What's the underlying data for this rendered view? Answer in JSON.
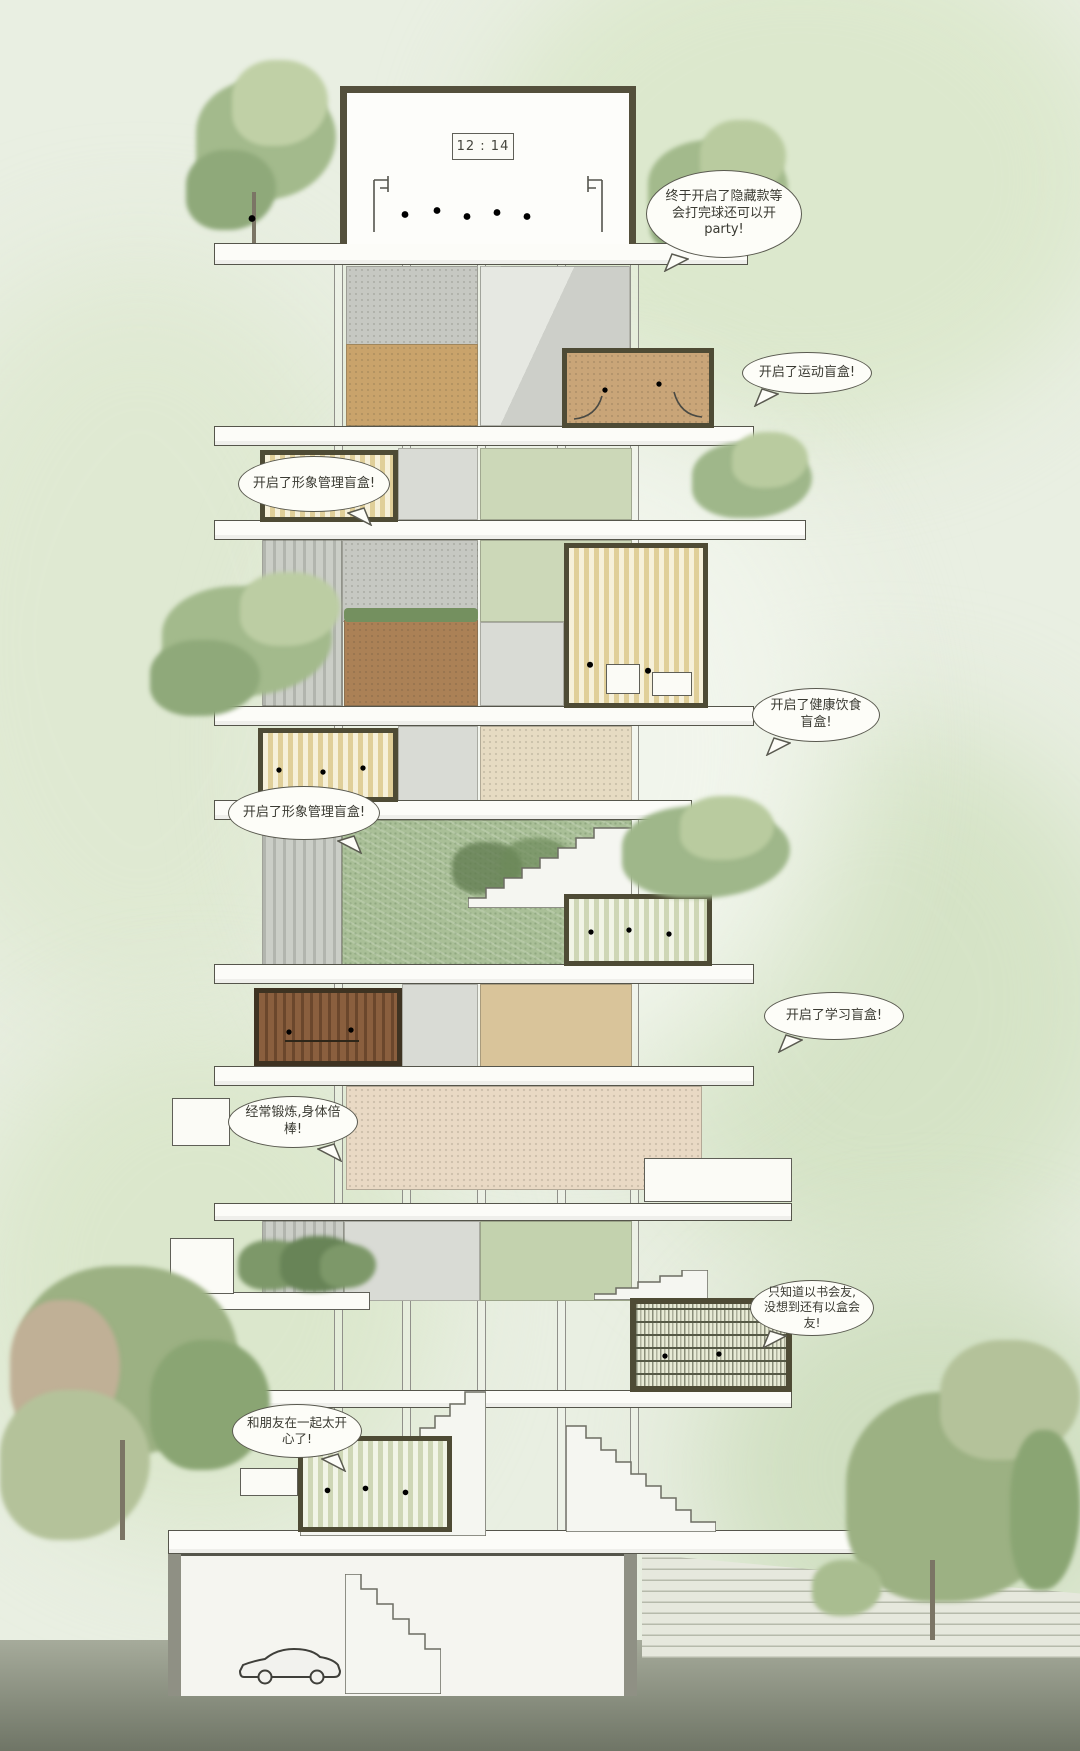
{
  "illustration": {
    "type": "architectural-section-illustration",
    "scoreboard": "12 : 14",
    "speech_bubbles": [
      {
        "name": "party",
        "text": "终于开启了隐藏款等会打完球还可以开party!"
      },
      {
        "name": "sports",
        "text": "开启了运动盲盒!"
      },
      {
        "name": "grooming-upper",
        "text": "开启了形象管理盲盒!"
      },
      {
        "name": "healthy-food",
        "text": "开启了健康饮食盲盒!"
      },
      {
        "name": "grooming-lower",
        "text": "开启了形象管理盲盒!"
      },
      {
        "name": "study",
        "text": "开启了学习盲盒!"
      },
      {
        "name": "fitness",
        "text": "经常锻炼,身体倍棒!"
      },
      {
        "name": "book-friends",
        "text": "只知道以书会友,没想到还有以盒会友!"
      },
      {
        "name": "friends-party",
        "text": "和朋友在一起太开心了!"
      }
    ],
    "rooms": [
      {
        "name": "rooftop-basketball-court",
        "interior_color": "#fdfdfa"
      },
      {
        "name": "sports-blindbox",
        "interior_color": "#c9a578"
      },
      {
        "name": "grooming-blindbox-upper",
        "interior_color": "#ecdfae"
      },
      {
        "name": "healthy-food-blindbox",
        "interior_color": "#ecdfae"
      },
      {
        "name": "grooming-blindbox-lower",
        "interior_color": "#ecdfae"
      },
      {
        "name": "study-blindbox",
        "interior_color": "#e3e8cc"
      },
      {
        "name": "fitness-blindbox",
        "interior_color": "#7c5233"
      },
      {
        "name": "reading-blindbox",
        "interior_color": "#e8ebd6"
      },
      {
        "name": "friends-blindbox",
        "interior_color": "#e3e8cc"
      }
    ],
    "palette": {
      "background": "#e9efe2",
      "foliage": "#a3ba8c",
      "slab": "#fcfcf8",
      "room_frame": "#4e4b35",
      "concrete": "#c6c8c2",
      "moss_green": "#a9bf97",
      "sage": "#ccd8b8",
      "tan": "#c9a36b",
      "brown": "#ab8156",
      "beige": "#e6dbc2",
      "ground": "#8f9486",
      "bubble_bg": "#fdfdf8",
      "line": "#55554b"
    }
  }
}
